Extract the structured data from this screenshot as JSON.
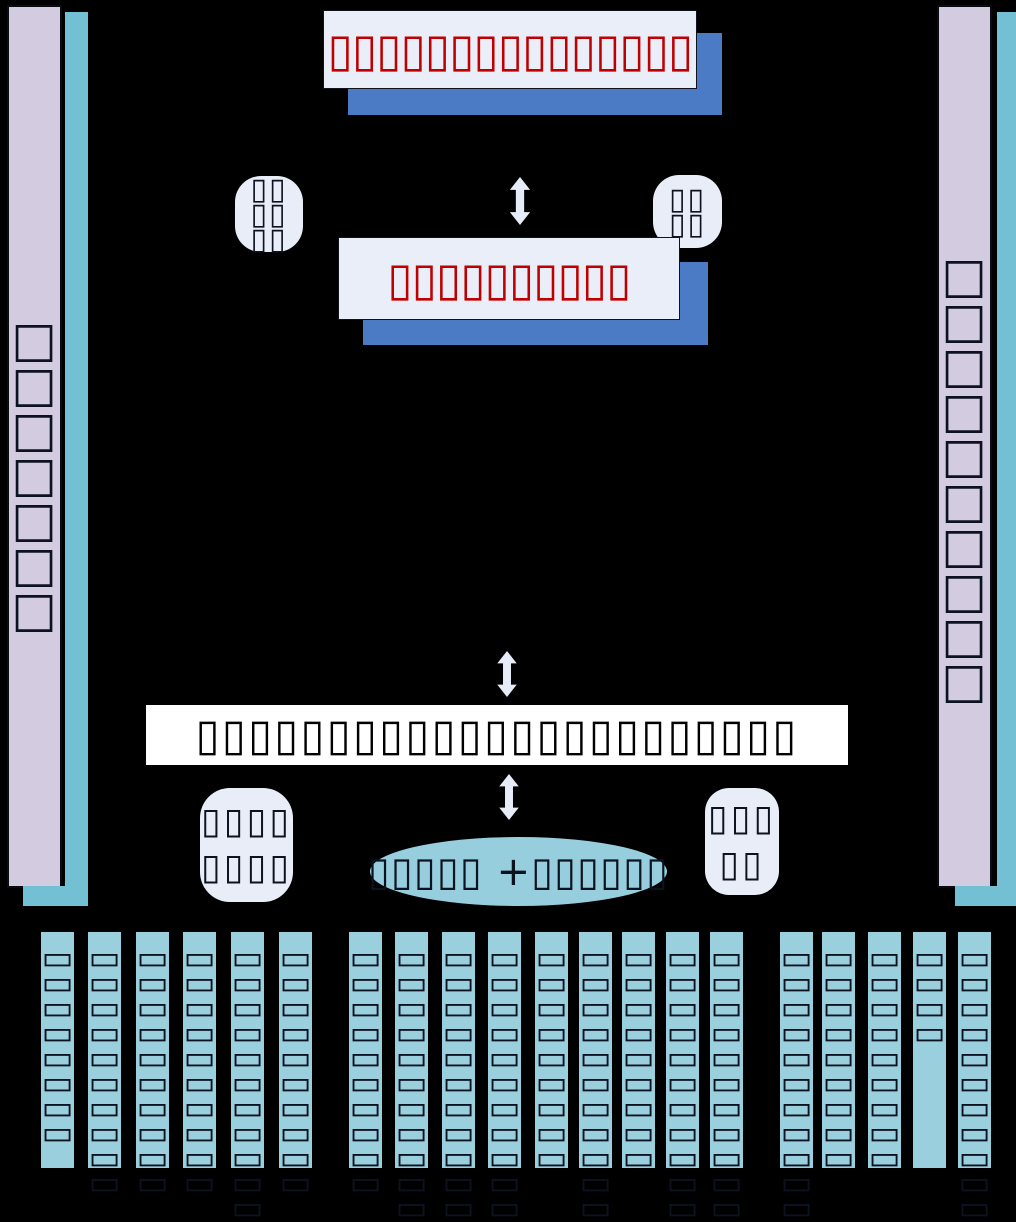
{
  "note": "All CJK text in the source screenshot rendered as missing-glyph tofu boxes; strings below reproduce the tofu glyphs exactly as shown.",
  "colors": {
    "background": "#000000",
    "box_fill": "#E9EEF8",
    "box_shadow_blue": "#4B7BC4",
    "title_tofu_red": "#C00000",
    "pillar_lavender": "#D3CCE0",
    "pillar_teal": "#73BFD4",
    "bottom_bar_teal": "#9AD0DE",
    "ellipse_teal": "#97CEDE",
    "bus_white": "#FFFFFF",
    "tofu_dark": "#0d1220",
    "arrow_fill": "#E7EDF8"
  },
  "top_box": {
    "text": "▯▯▯▯▯▯▯▯▯▯▯▯▯▯▯"
  },
  "second_box": {
    "text": "▯▯▯▯▯▯▯▯▯▯"
  },
  "left_pillar": {
    "text": "□□□□□□□"
  },
  "right_pillar": {
    "text": "□□□□□□□□□□"
  },
  "top_left_badge": {
    "lines": [
      "▯▯",
      "▯▯",
      "▯▯"
    ]
  },
  "top_right_badge": {
    "lines": [
      "▯▯",
      "▯▯"
    ]
  },
  "bottom_left_badge": {
    "lines": [
      "▯▯▯▯",
      "▯▯▯▯"
    ]
  },
  "bottom_right_badge": {
    "lines": [
      "▯▯▯",
      "▯▯"
    ]
  },
  "central_bus": {
    "text": "▯▯▯▯▯▯▯▯▯▯▯▯▯▯▯▯▯▯▯▯▯▯▯"
  },
  "ellipse": {
    "text": "▯▯▯▯▯ +▯▯▯▯▯▯"
  },
  "bottom_bars": {
    "items": [
      {
        "text": "▭▭▭▭▭▭▭▭"
      },
      {
        "text": "▭▭▭▭▭▭▭▭▭▭"
      },
      {
        "text": "▭▭▭▭▭▭▭▭▭▭"
      },
      {
        "text": "▭▭▭▭▭▭▭▭▭▭"
      },
      {
        "text": "▭▭▭▭▭▭▭▭▭▭▭▭▭"
      },
      {
        "text": "▭▭▭▭▭▭▭▭▭▭"
      },
      {
        "text": "▭▭▭▭▭▭▭▭▭▭"
      },
      {
        "text": "▭▭▭▭▭▭▭▭▭▭▭"
      },
      {
        "text": "▭▭▭▭▭▭▭▭▭▭▭▭"
      },
      {
        "text": "▭▭▭▭▭▭▭▭▭▭▭▭"
      },
      {
        "text": "▭▭▭▭▭▭▭▭▭"
      },
      {
        "text": "▭▭▭▭▭▭▭▭▭▭▭▭▭"
      },
      {
        "text": "▭▭▭▭▭▭▭▭▭"
      },
      {
        "text": "▭▭▭▭▭▭▭▭▭▭▭"
      },
      {
        "text": "▭▭▭▭▭▭▭▭▭▭▭"
      },
      {
        "text": "▭▭▭▭▭▭▭▭▭▭▭"
      },
      {
        "text": "▭▭▭▭▭▭▭▭▭"
      },
      {
        "text": "▭▭▭▭▭▭▭▭▭"
      },
      {
        "text": "▭▭▭▭"
      },
      {
        "text": "▭▭▭▭▭▭▭▭▭▭▭▭"
      }
    ]
  }
}
